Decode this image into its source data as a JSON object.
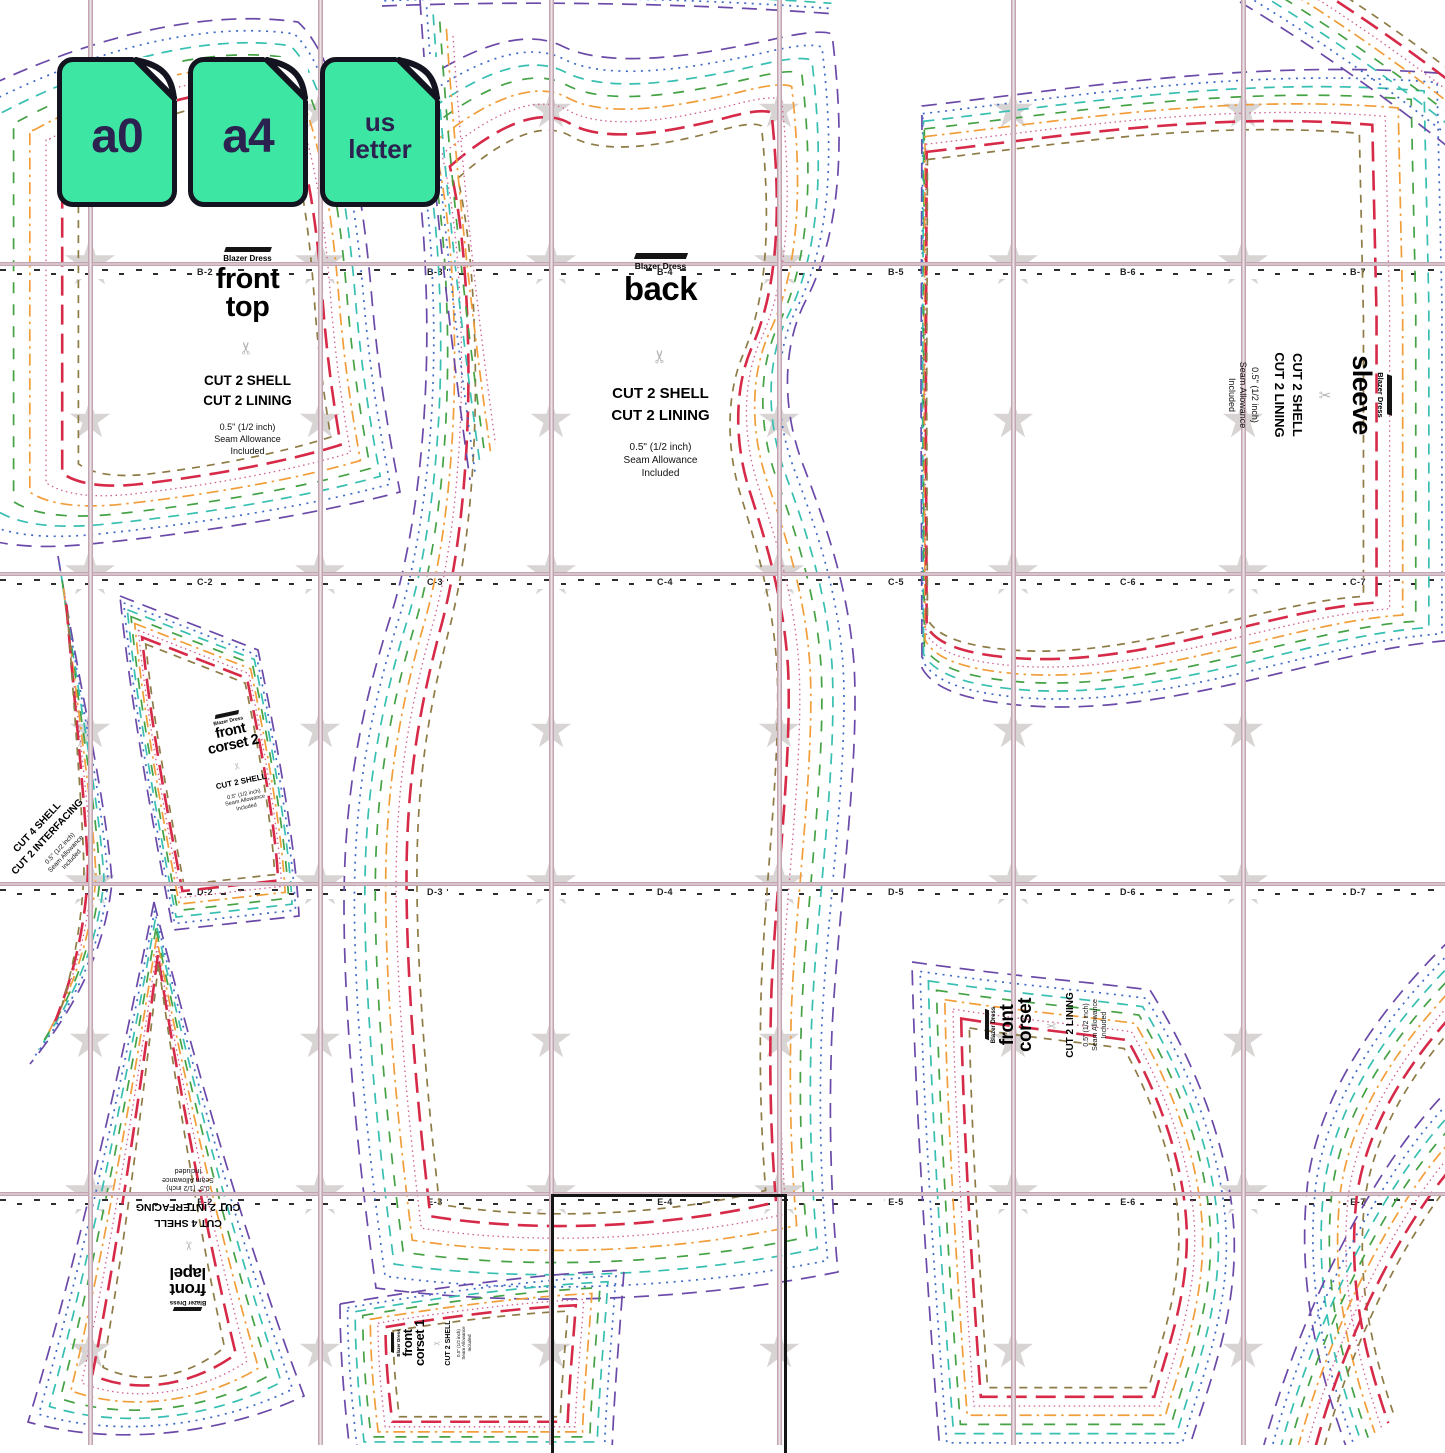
{
  "brand": {
    "name": "Blazer Dress"
  },
  "badges": {
    "items": [
      {
        "line1": "a0"
      },
      {
        "line1": "a4"
      },
      {
        "line1": "us",
        "line2": "letter"
      }
    ],
    "fill": "#3ee6a3",
    "text_color": "#2c2250",
    "border_color": "#141420"
  },
  "icons": {
    "scissors": "✂",
    "badge_shape": "page-with-folded-corner",
    "alignment_mark": "five-point-star"
  },
  "grid": {
    "row_letters": [
      "B",
      "C",
      "D",
      "E"
    ],
    "col_numbers": [
      "2",
      "3",
      "4",
      "5",
      "6",
      "7"
    ],
    "row_y": [
      263,
      573,
      883,
      1193
    ],
    "col_center_x": [
      205,
      435,
      665,
      896,
      1128,
      1358
    ],
    "line_x": [
      90,
      320,
      551,
      779,
      1013,
      1243
    ],
    "star_y": [
      110,
      263,
      420,
      573,
      730,
      883,
      1040,
      1193,
      1350
    ],
    "line_color": "#c2a5b1",
    "star_color": "#d6d0d0",
    "tick_color": "#2d2d2d",
    "selected_page": "E-4"
  },
  "sizes": [
    {
      "name": "size-1",
      "color": "#6a49a8",
      "dash": "15 9",
      "width": 1.7
    },
    {
      "name": "size-2",
      "color": "#3f69c6",
      "dash": "2 5.5",
      "width": 1.7
    },
    {
      "name": "size-3",
      "color": "#37bfb2",
      "dash": "11 8",
      "width": 1.7
    },
    {
      "name": "size-4",
      "color": "#44a244",
      "dash": "11 11",
      "width": 1.7
    },
    {
      "name": "size-5",
      "color": "#f19e3a",
      "dash": "12 5 2.5 5",
      "width": 1.7
    },
    {
      "name": "size-6",
      "color": "#cf5e94",
      "dash": "1.5 3.5",
      "width": 1.3
    },
    {
      "name": "size-7",
      "color": "#d62a48",
      "dash": "20 9",
      "width": 2.6
    },
    {
      "name": "size-8",
      "color": "#8e7b45",
      "dash": "8 7",
      "width": 1.7
    }
  ],
  "pieces": {
    "front_top": {
      "name1": "front",
      "name2": "top",
      "cut1": "CUT 2 SHELL",
      "cut2": "CUT 2 LINING",
      "seam1": "0.5\" (1/2 inch)",
      "seam2": "Seam Allowance",
      "seam3": "Included"
    },
    "back": {
      "name1": "back",
      "cut1": "CUT 2 SHELL",
      "cut2": "CUT 2 LINING",
      "seam1": "0.5\" (1/2 inch)",
      "seam2": "Seam Allowance",
      "seam3": "Included"
    },
    "sleeve": {
      "name1": "sleeve",
      "cut1": "CUT 2 SHELL",
      "cut2": "CUT 2 LINING",
      "seam1": "0.5\" (1/2 inch)",
      "seam2": "Seam Allowance",
      "seam3": "Included"
    },
    "front_corset_2": {
      "name1": "front",
      "name2": "corset 2",
      "cut1": "CUT 2 SHELL",
      "seam1": "0.5\" (1/2 inch)",
      "seam2": "Seam Allowance",
      "seam3": "Included"
    },
    "front_corset": {
      "name1": "front",
      "name2": "corset",
      "cut1": "CUT 2 LINING",
      "seam1": "0.5\" (1/2 inch)",
      "seam2": "Seam Allowance",
      "seam3": "Included"
    },
    "front_corset_1": {
      "name1": "front",
      "name2": "corset 1",
      "cut1": "CUT 2 SHELL",
      "seam1": "0.5\" (1/2 inch)",
      "seam2": "Seam Allowance",
      "seam3": "Included"
    },
    "front_lapel": {
      "name1": "front",
      "name2": "lapel",
      "cut1": "CUT 4 SHELL",
      "cut2": "CUT 2 INTERFACING",
      "seam1": "0.5\" (1/2 inch)",
      "seam2": "Seam Allowance",
      "seam3": "Included"
    },
    "side_note": {
      "cut1": "CUT 4 SHELL",
      "cut2": "CUT 2 INTERFACING",
      "seam1": "0.5\" (1/2 inch)",
      "seam2": "Seam Allowance",
      "seam3": "Included"
    }
  }
}
